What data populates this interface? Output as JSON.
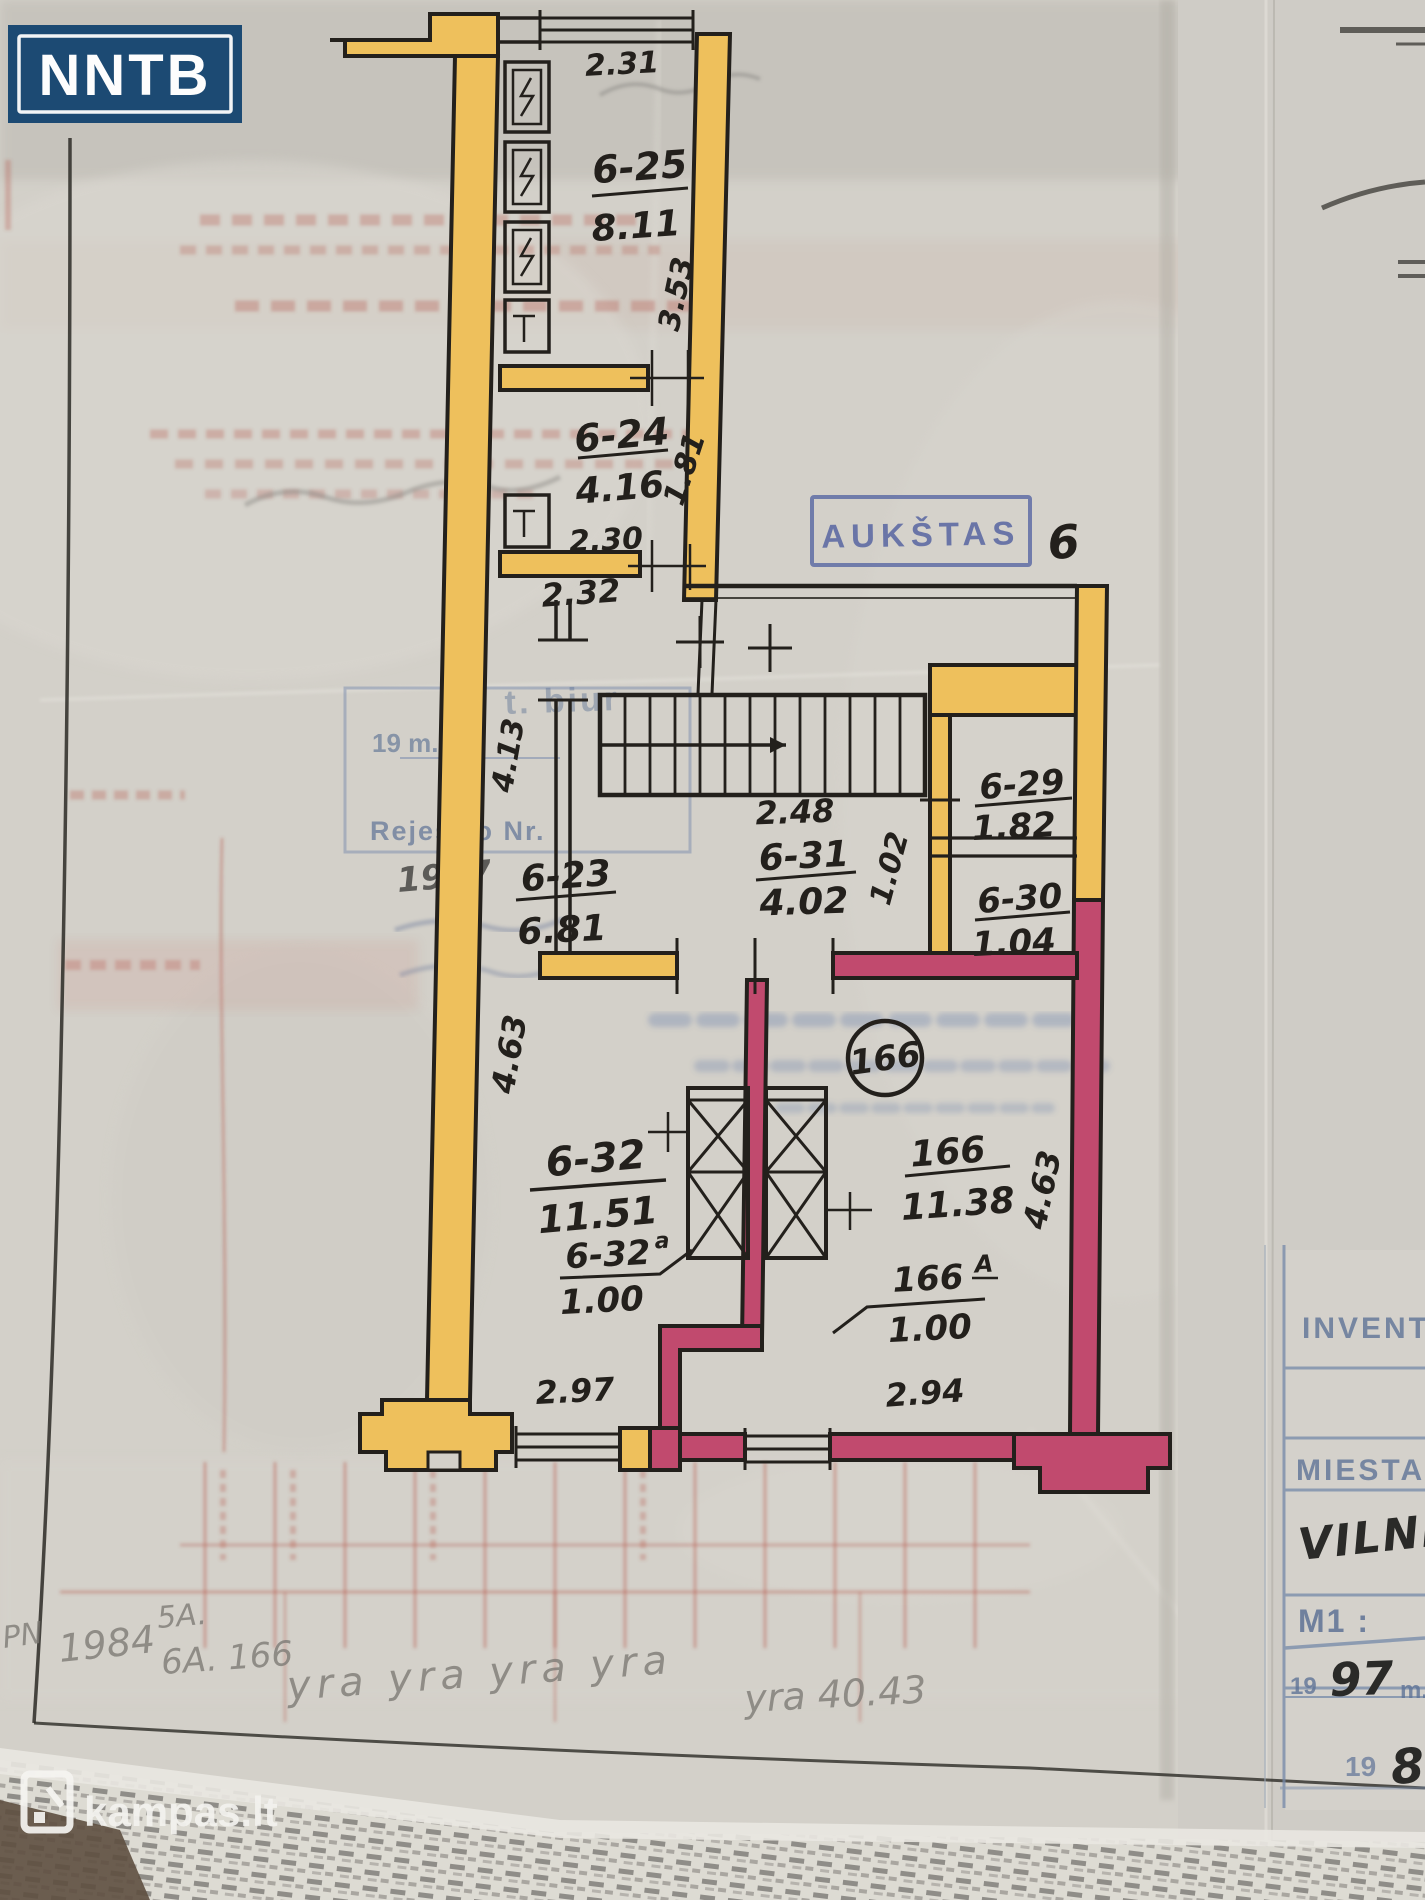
{
  "branding": {
    "logo_text": "NNTB",
    "watermark_text": "kampas.lt"
  },
  "plan": {
    "floor_stamp_label": "AUKŠTAS",
    "floor_number": "6",
    "apartment_badge": "166",
    "rooms": [
      {
        "code": "6-25",
        "area": "8.11"
      },
      {
        "code": "6-24",
        "area": "4.16"
      },
      {
        "code": "6-23",
        "area": "6.81"
      },
      {
        "code": "6-31",
        "area": "4.02"
      },
      {
        "code": "6-29",
        "area": "1.82"
      },
      {
        "code": "6-30",
        "area": "1.04"
      },
      {
        "code": "6-32",
        "area": "11.51"
      },
      {
        "code": "6-32",
        "sup": "a",
        "area": "1.00"
      },
      {
        "code": "166",
        "area": "11.38"
      },
      {
        "code": "166",
        "sup": "A",
        "area": "1.00"
      }
    ],
    "dimensions": {
      "top_window": "2.31",
      "room625_depth": "3.53",
      "room624_depth": "1.81",
      "room624_width": "2.30",
      "corridor_width": "2.32",
      "hall_depth": "4.13",
      "stair_width": "2.48",
      "closet_depth": "1.02",
      "room632_depth": "4.63",
      "room166_depth": "4.63",
      "room632_width": "2.97",
      "room166_width": "2.94"
    }
  },
  "faint_marks": {
    "stamp_box_year": "19        m.",
    "stamp_box_registry": "Rejestro Nr.",
    "stamp_box_hand_year": "1947",
    "blue_text_fragment": "t. biur",
    "pencil": {
      "left_margin": "PN",
      "year": "1984",
      "flat_a": "5A.",
      "flat_b": "6A. 166",
      "repeat": "yra    yra    yra    yra",
      "right": "yra  40.43"
    }
  },
  "side_card": {
    "header": "INVENT",
    "city_label": "MIESTAS",
    "city_value": "VILNIU",
    "scale_label": "M1 :",
    "year_prefix": "19",
    "year_hand": "97",
    "meters": "m.",
    "year2_prefix": "19",
    "year2_hand": "8"
  }
}
